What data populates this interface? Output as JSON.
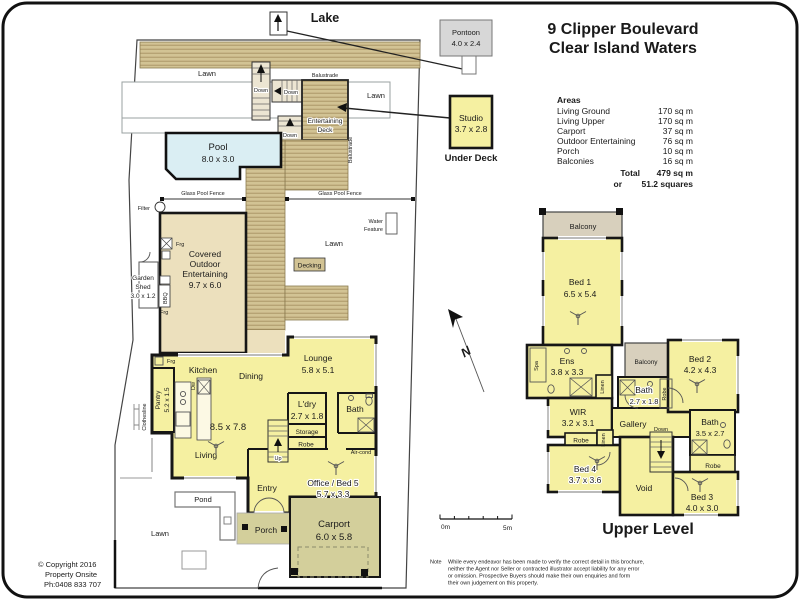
{
  "header": {
    "title_line1": "9 Clipper Boulevard",
    "title_line2": "Clear Island Waters"
  },
  "areas": {
    "heading": "Areas",
    "rows": [
      {
        "label": "Living Ground",
        "value": "170 sq m"
      },
      {
        "label": "Living Upper",
        "value": "170 sq m"
      },
      {
        "label": "Carport",
        "value": "37 sq m"
      },
      {
        "label": "Outdoor Entertaining",
        "value": "76 sq m"
      },
      {
        "label": "Porch",
        "value": "10 sq m"
      },
      {
        "label": "Balconies",
        "value": "16 sq m"
      }
    ],
    "total_label": "Total",
    "total_value": "479 sq m",
    "or_label": "or",
    "or_value": "51.2 squares"
  },
  "site": {
    "lake": "Lake",
    "pontoon_name": "Pontoon",
    "pontoon_size": "4.0 x 2.4",
    "studio_name": "Studio",
    "studio_size": "3.7 x 2.8",
    "under_deck": "Under Deck",
    "lawn_top": "Lawn",
    "lawn_right": "Lawn",
    "lawn_mid": "Lawn",
    "lawn_bottom": "Lawn",
    "garden_upper": "Garden",
    "garden_lower": "Garden",
    "pool_name": "Pool",
    "pool_size": "8.0 x 3.0",
    "balustrade_top": "Balustrade",
    "balustrade_side": "Balustrade",
    "ent_deck_line1": "Entertaining",
    "ent_deck_line2": "Deck",
    "down_1": "Down",
    "down_2": "Down",
    "down_3": "Down",
    "fence_left": "Glass Pool Fence",
    "fence_right": "Glass Pool Fence",
    "filter": "Filter",
    "water_line1": "Water",
    "water_line2": "Feature",
    "decking": "Decking",
    "shed_line1": "Garden",
    "shed_line2": "Shed",
    "shed_size": "3.0 x 1.2",
    "frg_top": "Frg",
    "frg_bottom": "Frg",
    "bbq": "BBQ",
    "clothesline": "Clothesline",
    "pond": "Pond"
  },
  "ground": {
    "covered_line1": "Covered",
    "covered_line2": "Outdoor",
    "covered_line3": "Entertaining",
    "covered_size": "9.7 x 6.0",
    "kitchen": "Kitchen",
    "frg": "Frg",
    "dw": "Dw",
    "dining": "Dining",
    "lounge_name": "Lounge",
    "lounge_size": "5.8 x 5.1",
    "pantry_name": "Pantry",
    "pantry_size": "5.2 x 1.5",
    "main_size": "8.5 x 7.8",
    "living": "Living",
    "ldry_name": "L'dry",
    "ldry_size": "2.7 x 1.8",
    "storage": "Storage",
    "robe": "Robe",
    "bath": "Bath",
    "aircond": "Air-cond",
    "up": "Up",
    "entry": "Entry",
    "office_name": "Office / Bed 5",
    "office_size": "5.7 x 3.3",
    "porch": "Porch",
    "carport_name": "Carport",
    "carport_size": "6.0 x 5.8"
  },
  "upper": {
    "balcony_top": "Balcony",
    "balcony_mid": "Balcony",
    "bed1_name": "Bed 1",
    "bed1_size": "6.5 x 5.4",
    "ens_name": "Ens",
    "ens_size": "3.8 x 3.3",
    "spa": "Spa",
    "linen_ens": "Linen",
    "linen_hall": "Linen",
    "wir_name": "WIR",
    "wir_size": "3.2 x 3.1",
    "robe_hall": "Robe",
    "bath1_name": "Bath",
    "bath1_size": "2.7 x 1.8",
    "robe_bath": "Robe",
    "bed2_name": "Bed 2",
    "bed2_size": "4.2 x 4.3",
    "gallery": "Gallery",
    "down": "Down",
    "void": "Void",
    "bed4_name": "Bed 4",
    "bed4_size": "3.7 x 3.6",
    "bath2_name": "Bath",
    "bath2_size": "3.5 x 2.7",
    "robe_bed3": "Robe",
    "bed3_name": "Bed 3",
    "bed3_size": "4.0 x 3.0",
    "level_label": "Upper Level"
  },
  "footer": {
    "note_label": "Note",
    "note_lines": [
      "While every endeavor has been made to verify the correct detail in this brochure,",
      "neither the Agent nor Seller or contracted illustrator accept liability for any error",
      "or omission. Prospective Buyers should make their own enquiries and form",
      "their own judgement on this property."
    ],
    "copyright_lines": [
      "© Copyright 2016",
      "Property Onsite",
      "Ph:0408 833 707"
    ],
    "scale_start": "0m",
    "scale_end": "5m",
    "compass_n": "N"
  }
}
